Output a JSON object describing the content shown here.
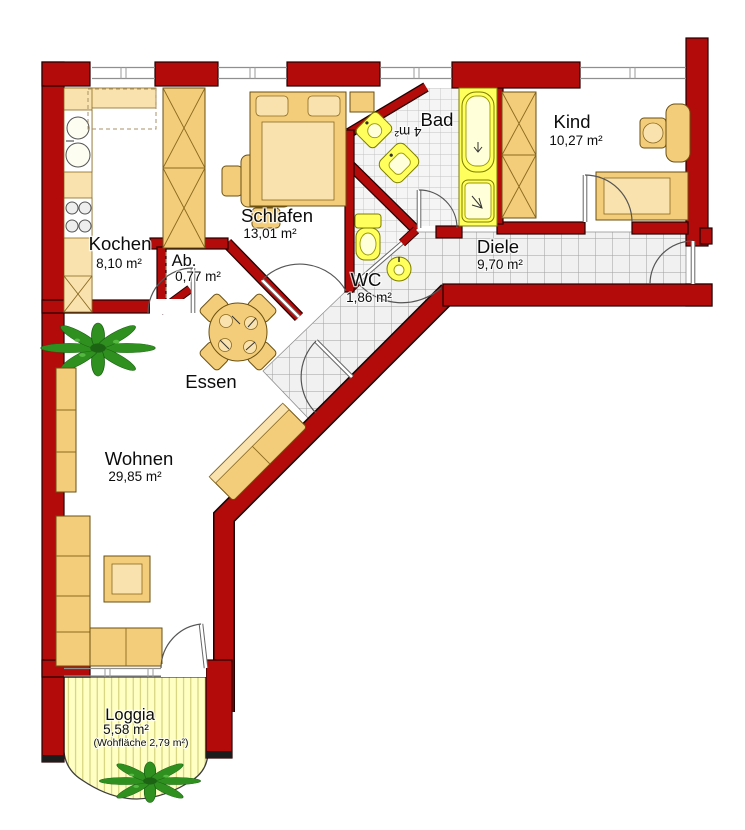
{
  "rooms": {
    "kochen": {
      "label": "Kochen",
      "area": "8,10 m²"
    },
    "ab": {
      "label": "Ab.",
      "area": "0,77 m²"
    },
    "schlafen": {
      "label": "Schlafen",
      "area": "13,01 m²"
    },
    "bad": {
      "label": "Bad",
      "area_rotated": "4 m²"
    },
    "wc": {
      "label": "WC",
      "area": "1,86 m²"
    },
    "kind": {
      "label": "Kind",
      "area": "10,27 m²"
    },
    "diele": {
      "label": "Diele",
      "area": "9,70 m²"
    },
    "essen": {
      "label": "Essen"
    },
    "wohnen": {
      "label": "Wohnen",
      "area": "29,85 m²"
    },
    "loggia": {
      "label": "Loggia",
      "area": "5,58 m²",
      "note": "(Wohfläche 2,79 m²)"
    }
  },
  "colors": {
    "wall": "#b30a0a",
    "furniture": "#f3cd79",
    "fixture": "#ffff5e",
    "tile-line": "#9f9f9f",
    "loggia-fill": "#ffffc4",
    "plant": "#2f8f1f"
  }
}
